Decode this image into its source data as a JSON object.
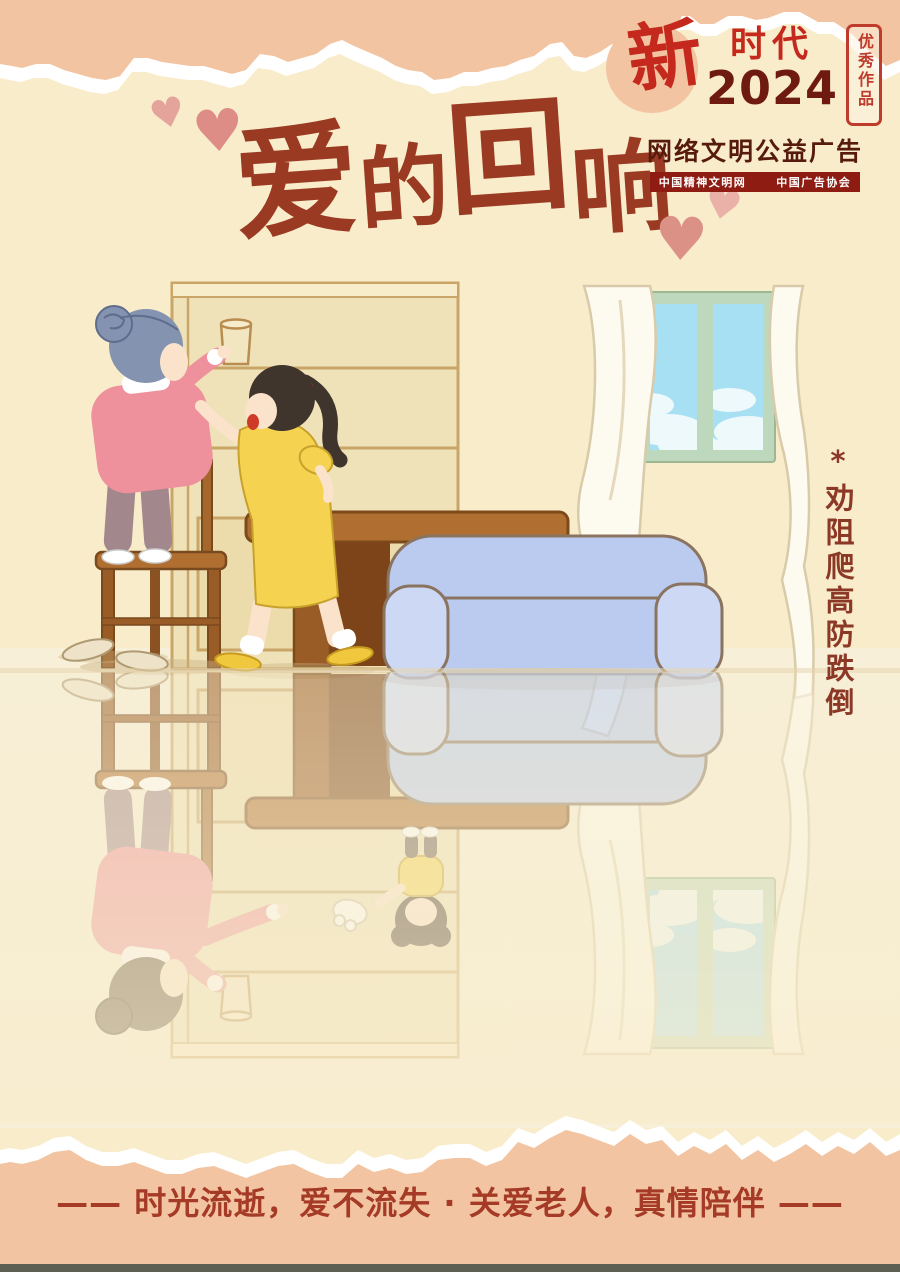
{
  "badge": {
    "brand_char": "新",
    "brand_word": "时代",
    "year": "2024",
    "seal": "优秀作品",
    "subtitle": "网络文明公益广告",
    "banner_left": "中国精神文明网",
    "banner_right": "中国广告协会"
  },
  "title": {
    "text": "爱的回响",
    "chars": [
      "爱",
      "的",
      "回",
      "响"
    ]
  },
  "side_note": "*劝阻爬高防跌倒",
  "slogan": "—— 时光流逝，爱不流失 · 关爱老人，真情陪伴 ——",
  "icons": {
    "heart": "♥"
  },
  "colors": {
    "background_cream": "#f8ecca",
    "torn_peach": "#f2c4a1",
    "title_brown": "#9b3a22",
    "slogan_red": "#a53a26",
    "badge_red": "#c5281c",
    "badge_year_dark": "#6e1a10",
    "banner_background": "#8e1c12",
    "side_note_color": "#8c3826",
    "heart_pink_light": "#e5a49b",
    "heart_pink_dark": "#dd8d85",
    "sofa_blue": "#bacbef",
    "window_frame_green": "#bdd8bd",
    "sky_blue": "#a8e0f3",
    "bottom_bar": "#5e5f53"
  },
  "scene": {
    "elements": [
      "bookshelf",
      "cup-on-shelf",
      "window",
      "curtains",
      "sofa",
      "table",
      "wooden-chair",
      "grandmother-climbing",
      "granddaughter-warning",
      "slippers",
      "floor-reflection-of-past"
    ]
  }
}
